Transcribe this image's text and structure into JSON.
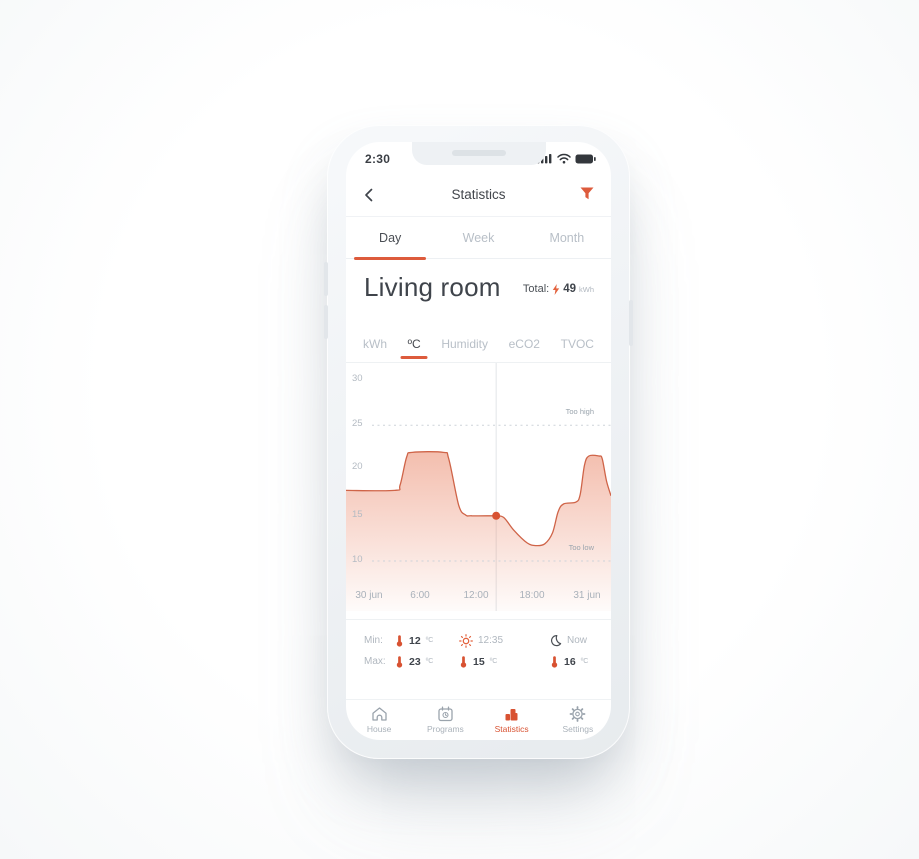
{
  "colors": {
    "accent": "#dd5b3c",
    "dot": "#d85232",
    "curve_stroke": "#cf6448",
    "fill_top": "#e98263",
    "text_dark": "#3f444b",
    "text_gray": "#b5bcc4",
    "bezel": "#eef1f4"
  },
  "status_bar": {
    "time": "2:30",
    "icons": [
      "cellular-signal-icon",
      "wifi-icon",
      "battery-icon"
    ]
  },
  "header": {
    "title": "Statistics",
    "back_icon": "chevron-left",
    "filter_icon": "funnel"
  },
  "period_tabs": [
    {
      "label": "Day",
      "active": true
    },
    {
      "label": "Week",
      "active": false
    },
    {
      "label": "Month",
      "active": false
    }
  ],
  "room": {
    "title": "Living room",
    "total_label": "Total:",
    "total_value": "49",
    "total_unit": "kWh"
  },
  "metric_tabs": [
    {
      "label": "kWh",
      "active": false
    },
    {
      "label": "ºC",
      "active": true
    },
    {
      "label": "Humidity",
      "active": false
    },
    {
      "label": "eCO2",
      "active": false
    },
    {
      "label": "TVOC",
      "active": false
    }
  ],
  "chart_data": {
    "type": "area",
    "unit": "ºC",
    "x_ticks": [
      "30 jun",
      "6:00",
      "12:00",
      "18:00",
      "31 jun"
    ],
    "y_ticks": [
      "30",
      "25",
      "20",
      "15",
      "10"
    ],
    "xlim_hours": [
      0,
      24
    ],
    "ylim": [
      8,
      32
    ],
    "grid": "off",
    "thresholds": {
      "too_high": {
        "value": 25,
        "label": "Too high"
      },
      "too_low": {
        "value": 10,
        "label": "Too low"
      }
    },
    "selected_point": {
      "hour": 13.6,
      "value": 15
    },
    "series": [
      {
        "name": "Temperature",
        "points": [
          [
            0,
            17.8
          ],
          [
            4.4,
            17.8
          ],
          [
            4.9,
            18.4
          ],
          [
            5.5,
            21.5
          ],
          [
            6.0,
            22.0
          ],
          [
            8.8,
            22.0
          ],
          [
            9.3,
            21.3
          ],
          [
            10.2,
            16.2
          ],
          [
            10.8,
            15.1
          ],
          [
            11.4,
            15.0
          ],
          [
            13.2,
            15.0
          ],
          [
            13.6,
            15.0
          ],
          [
            14.3,
            14.8
          ],
          [
            15.2,
            13.4
          ],
          [
            16.4,
            12.0
          ],
          [
            17.2,
            11.7
          ],
          [
            18.0,
            11.9
          ],
          [
            18.7,
            13.1
          ],
          [
            19.2,
            15.4
          ],
          [
            19.7,
            16.3
          ],
          [
            20.8,
            16.5
          ],
          [
            21.2,
            17.3
          ],
          [
            21.6,
            20.6
          ],
          [
            22.0,
            21.6
          ],
          [
            22.9,
            21.6
          ],
          [
            23.2,
            21.3
          ],
          [
            23.6,
            18.8
          ],
          [
            24,
            17.2
          ]
        ]
      }
    ]
  },
  "stats": {
    "min_label": "Min:",
    "min_value": "12",
    "max_label": "Max:",
    "max_value": "23",
    "unit": "ºC",
    "sun_time": "12:35",
    "sun_temp": "15",
    "moon_label": "Now",
    "moon_temp": "16"
  },
  "nav": [
    {
      "label": "House",
      "active": false
    },
    {
      "label": "Programs",
      "active": false
    },
    {
      "label": "Statistics",
      "active": true
    },
    {
      "label": "Settings",
      "active": false
    }
  ]
}
